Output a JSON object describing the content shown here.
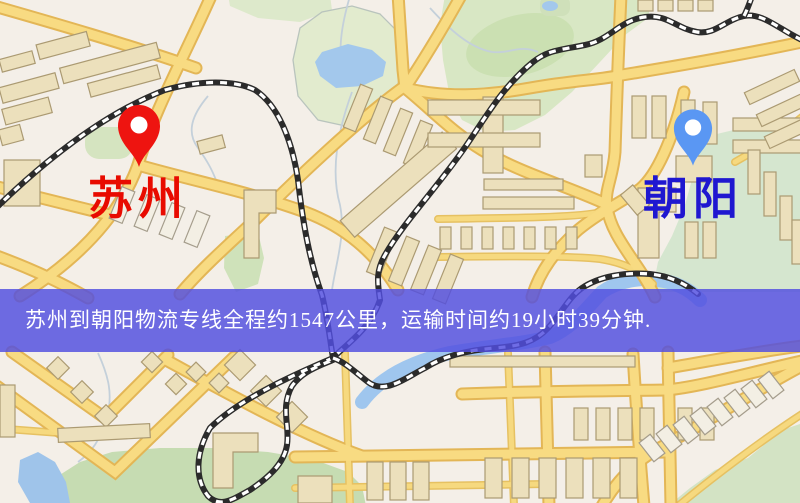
{
  "banner": {
    "text": "苏州到朝阳物流专线全程约1547公里，运输时间约19小时39分钟.",
    "background_color": "#524ee0",
    "text_color": "#ffffff"
  },
  "origin": {
    "label": "苏州",
    "pin_color": "#ee1410",
    "label_color": "#e80b00"
  },
  "destination": {
    "label": "朝阳",
    "pin_color": "#5a97f3",
    "label_color": "#1f17d0"
  },
  "route": {
    "service_type": "物流专线",
    "distance_km": "1547",
    "duration": "19小时39分钟"
  },
  "map_colors": {
    "land": "#f4efe8",
    "park": "#d8e7c4",
    "water": "#a1c6ec",
    "road": "#f8db82",
    "railway": "#2b2b2b",
    "building": "#ece0bc"
  }
}
